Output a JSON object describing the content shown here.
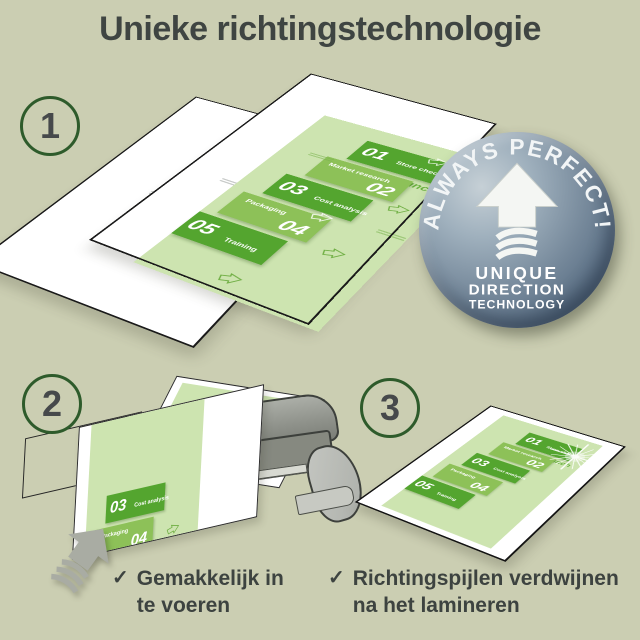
{
  "title": "Unieke richtingstechnologie",
  "steps": {
    "one": "1",
    "two": "2",
    "three": "3"
  },
  "badge": {
    "arc_text": "ALWAYS PERFECT!",
    "line1": "UNIQUE",
    "line2": "DIRECTION",
    "line3": "TECHNOLOGY"
  },
  "flyer": {
    "launch": "Launch",
    "items": [
      {
        "num": "01",
        "label": "Store check"
      },
      {
        "num": "02",
        "label": "Market research"
      },
      {
        "num": "03",
        "label": "Cost analysis"
      },
      {
        "num": "04",
        "label": "Packaging"
      },
      {
        "num": "05",
        "label": "Training"
      }
    ]
  },
  "checklist": {
    "check": "✓",
    "items": [
      {
        "line1": "Gemakkelijk in",
        "line2": "te voeren"
      },
      {
        "line1": "Richtingspijlen verdwijnen",
        "line2": "na het lamineren"
      }
    ]
  },
  "colors": {
    "background": "#cbceb2",
    "dark_green": "#54a52f",
    "medium_green": "#8dc158",
    "flyer_background": "#cde4b0",
    "badge_blue": "#6e8296",
    "text": "#3d4340"
  }
}
